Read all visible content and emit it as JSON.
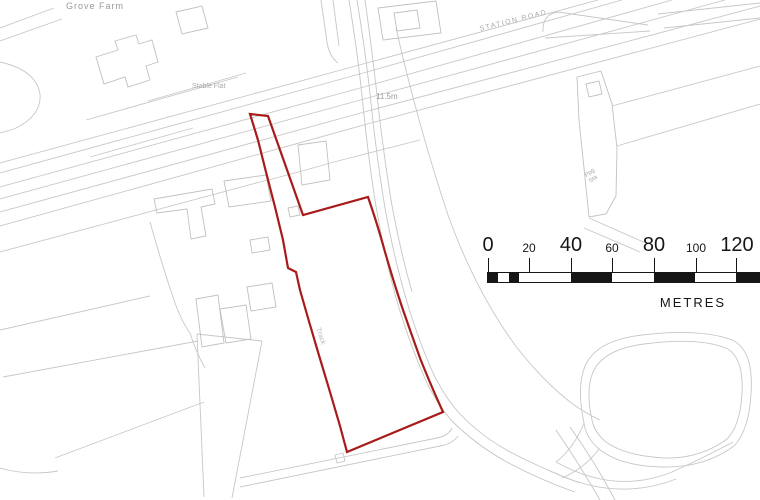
{
  "title": "Site location plan",
  "map": {
    "background_color": "#ffffff",
    "linework_color": "#c6c8c6",
    "labels": {
      "farm_name": "Grove Farm",
      "stable_flat": "Stable Flat",
      "road_name": "STATION ROAD",
      "spot_height": "11.5m",
      "track": "Track",
      "pumping_station": "Ppg Sta"
    },
    "boundary": {
      "color": "#a81b1b",
      "path": "M250,114 L268,116 L303,215 L368,197 Q378,226 385,252 Q394,283 402,307 Q411,333 420,358 Q429,381 443,412 L347,452 L340,426 L330,392 L318,352 L308,318 L300,290 L296,272 L288,268 L283,240 L275,207 L266,172 L258,140 Z"
    }
  },
  "scalebar": {
    "color": "#161616",
    "unit_label": "METRES",
    "ticks": [
      {
        "text": "0",
        "metres": 0,
        "major": true
      },
      {
        "text": "20",
        "metres": 20,
        "major": false
      },
      {
        "text": "40",
        "metres": 40,
        "major": true
      },
      {
        "text": "60",
        "metres": 60,
        "major": false
      },
      {
        "text": "80",
        "metres": 80,
        "major": true
      },
      {
        "text": "100",
        "metres": 100,
        "major": false
      },
      {
        "text": "120",
        "metres": 120,
        "major": true
      }
    ]
  }
}
